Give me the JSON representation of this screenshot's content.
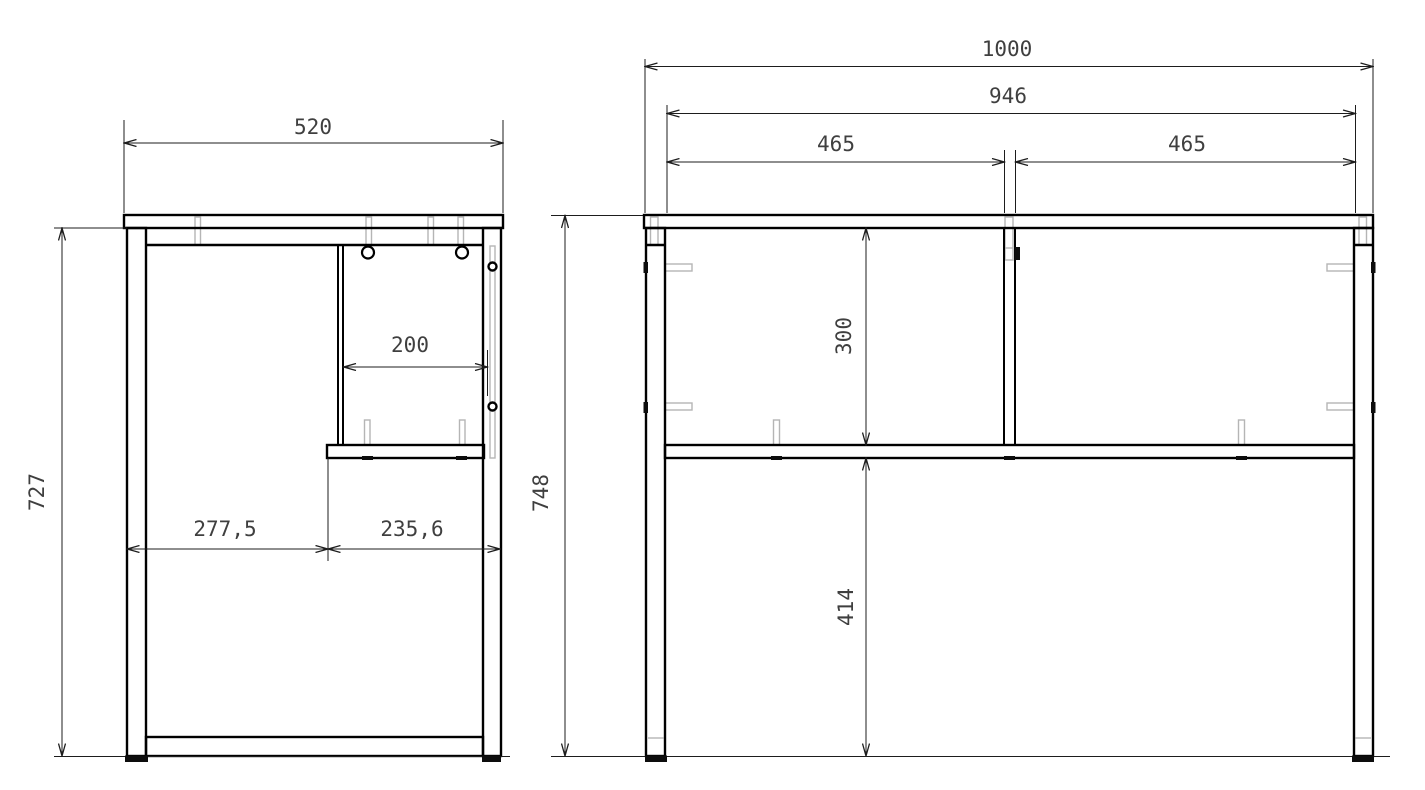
{
  "page": {
    "background": "#ffffff",
    "line_color": "#000000",
    "hidden_line_color": "#b5b5b5",
    "dim_text_color": "#3f3f3f"
  },
  "drawing": {
    "kind": "furniture orthographic technical drawing (desk frame, side view and front view)",
    "side_view": {
      "dims": {
        "top_width": "520",
        "panel_offset": "200",
        "bay_left": "277,5",
        "bay_right": "235,6",
        "leg_height": "727"
      }
    },
    "front_view": {
      "dims": {
        "overall_width": "1000",
        "inner_width": "946",
        "bay_left": "465",
        "bay_right": "465",
        "top_to_shelf": "300",
        "shelf_to_floor": "414",
        "overall_height": "748"
      }
    }
  }
}
